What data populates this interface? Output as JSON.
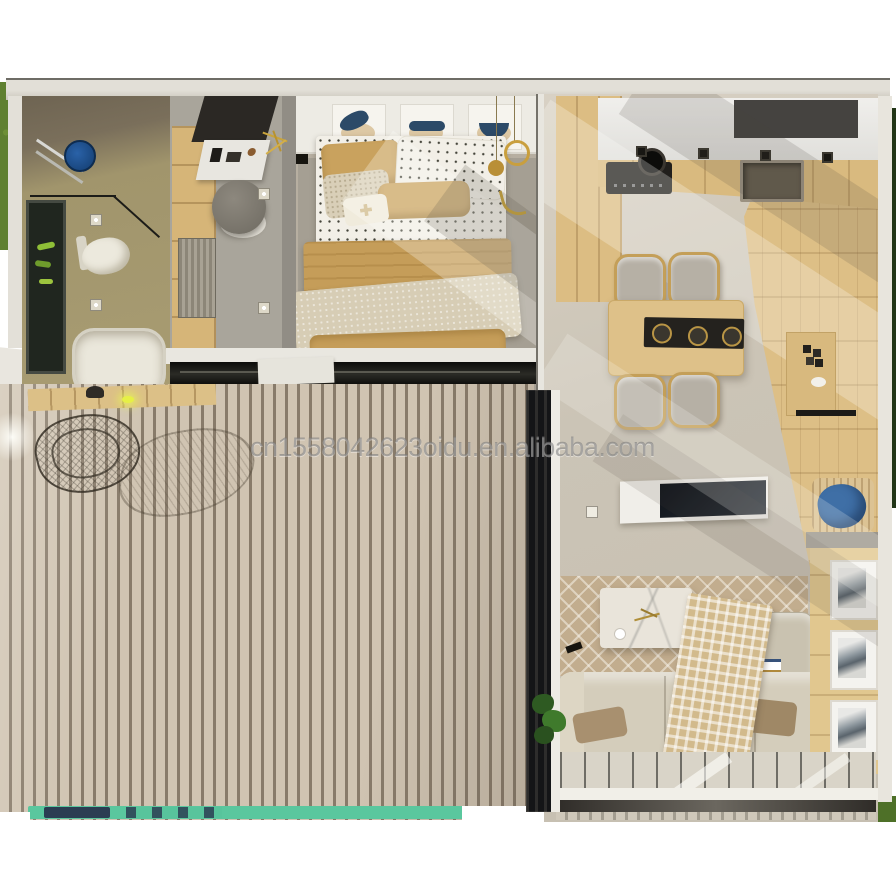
{
  "watermark": {
    "text": "cn1558042623oidu.en.alibaba.com"
  },
  "scene": {
    "type": "3d-top-down-floor-plan-render",
    "rooms": [
      "bathroom",
      "entry-hall",
      "bedroom",
      "kitchen",
      "dining-area",
      "living-room",
      "deck"
    ],
    "objects": [
      "shower-head",
      "towel-rack",
      "toilet",
      "bathtub",
      "window-with-plants",
      "wardrobe",
      "console-cabinet",
      "gold-wall-decor",
      "round-pouf",
      "doormat",
      "floor-spotlights",
      "double-bed",
      "polka-dot-bedding",
      "camel-blanket",
      "beige-throw",
      "wall-art-frames",
      "gold-pendant-lights",
      "kitchen-counter",
      "cooktop",
      "pot",
      "kitchen-sink",
      "dark-upper-panel",
      "dining-table",
      "black-table-runner",
      "four-chairs",
      "wall-desk",
      "tv-console",
      "tv",
      "diamond-pattern-rug",
      "marble-coffee-table",
      "l-shaped-sofa",
      "checkered-throw-blanket",
      "brown-pillows",
      "wicker-basket-with-blue-cloth",
      "wood-cabinet-with-frames",
      "glass-wall",
      "potted-plant",
      "wood-slat-deck",
      "wire-lounge-chair",
      "deck-walkway",
      "deck-light",
      "pool-edge-strip"
    ]
  },
  "colors": {
    "canvas": "#ffffff",
    "watermark_gray": "#7a7a7a",
    "grass": "#5f8030",
    "deck_slat": "#d0c4b2",
    "deck_gap": "#887b6a",
    "teal_strip": "#5ac79e",
    "navy_patch": "#2b3d52",
    "wood": "#dcbf86",
    "concrete_floor": "#cbc4b6",
    "camel_textile": "#c59d59",
    "navy_art": "#2c4a68",
    "shower_blue": "#2a62a8",
    "basket_blue": "#3f6fa6",
    "dark_glass": "#141517",
    "counter_white": "#f0efec",
    "sofa_beige": "#d4cdbb"
  }
}
